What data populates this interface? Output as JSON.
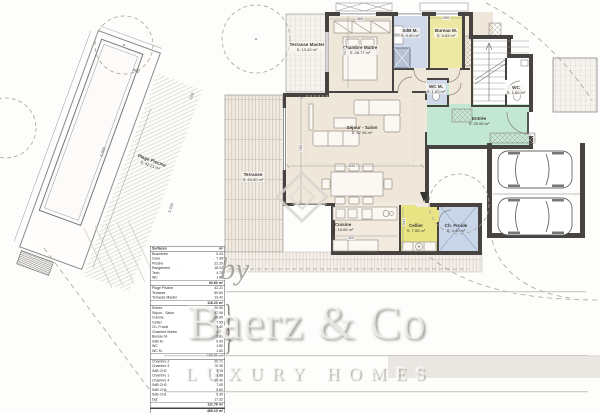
{
  "plan": {
    "rooms": {
      "terrasse_master": {
        "name": "Terrasse Master",
        "area": "S: 13.42 m²"
      },
      "chambre_maitre": {
        "name": "Chambre Maitre",
        "area": "S: 28.77 m²"
      },
      "sdb_m": {
        "name": "SdB M.",
        "area": "S: 9.90 m²"
      },
      "bureau_m": {
        "name": "Bureau M.",
        "area": "S: 9.83 m²"
      },
      "wc_m": {
        "name": "WC M.",
        "area": "S: 1.60 m²"
      },
      "wc": {
        "name": "WC",
        "area": "S: 1.80 m²"
      },
      "entree": {
        "name": "Entrée",
        "area": "S: 20.95 m²"
      },
      "sejour_salon": {
        "name": "Séjour - Salon",
        "area": "S: 67.06 m²"
      },
      "terrasse": {
        "name": "Terrasse",
        "area": "S: 60.60 m²"
      },
      "cuisine": {
        "name": "Cuisine",
        "area": "S: 16.65 m²"
      },
      "cellier": {
        "name": "Cellier",
        "area": "S: 7.55 m²"
      },
      "ch_froide": {
        "name": "Ch. Froide",
        "area": "S: 4.40 m²"
      },
      "plage_piscine": {
        "name": "Plage Piscine",
        "area": "S: 42.21 m²"
      }
    },
    "dimensions": {
      "chambre_width": "365",
      "bureau_width": "250",
      "chambre_height": "507",
      "sejour_height": "760",
      "sejour_width": "835",
      "cuisine_height": "341",
      "cuisine_width": "420",
      "pool_width": "400",
      "pool_length": "1.000",
      "deck_width": "200",
      "deck_length": "1.200"
    }
  },
  "surface_table": {
    "header": {
      "label": "Surfaces",
      "value": "m²"
    },
    "brace": "}",
    "sections": [
      {
        "rows": [
          {
            "label": "Buanderie",
            "value": "9.43"
          },
          {
            "label": "Cave",
            "value": "7.36"
          },
          {
            "label": "Piscine",
            "value": "22.29"
          },
          {
            "label": "Rangement",
            "value": "18.02"
          },
          {
            "label": "Tech.",
            "value": "4.70"
          },
          {
            "label": "WC",
            "value": "1.80"
          }
        ],
        "total": "63.60 m²"
      },
      {
        "rows": [
          {
            "label": "Plage Piscine",
            "value": "42.21"
          },
          {
            "label": "Terrasse",
            "value": "60.60"
          },
          {
            "label": "Terrasse Master",
            "value": "13.42"
          }
        ],
        "total": "116.23 m²"
      },
      {
        "rows": [
          {
            "label": "Entrée",
            "value": "20.95"
          },
          {
            "label": "Séjour - Salon",
            "value": "67.06"
          },
          {
            "label": "Cuisine",
            "value": "16.65"
          },
          {
            "label": "Cellier",
            "value": "7.55"
          },
          {
            "label": "Ch. Froide",
            "value": "4.40"
          },
          {
            "label": "Chambre Maitre",
            "value": "28.77"
          },
          {
            "label": "Bureau M.",
            "value": "9.83"
          },
          {
            "label": "SdB M.",
            "value": "9.90"
          },
          {
            "label": "WC",
            "value": "1.80"
          },
          {
            "label": "WC M.",
            "value": "1.60"
          }
        ],
        "total": "168.51 m²"
      },
      {
        "rows": [
          {
            "label": "Chambre 2",
            "value": "20.71"
          },
          {
            "label": "Chambre 3",
            "value": "16.35"
          },
          {
            "label": "SdB CH2",
            "value": "5.15"
          },
          {
            "label": "Chambre 1",
            "value": "18.88"
          },
          {
            "label": "Chambre 4",
            "value": "15.40"
          },
          {
            "label": "SdB CH3",
            "value": "7.05"
          },
          {
            "label": "SdB CH4",
            "value": "5.60"
          },
          {
            "label": "SdB CH1",
            "value": "5.30"
          },
          {
            "label": "Dgt",
            "value": "17.32"
          }
        ],
        "total": "111.76 m²"
      }
    ],
    "grand_total": "460.10 m²"
  },
  "watermark": {
    "by": "by",
    "brand": "Baerz & Co",
    "tagline": "LUXURY HOMES"
  }
}
